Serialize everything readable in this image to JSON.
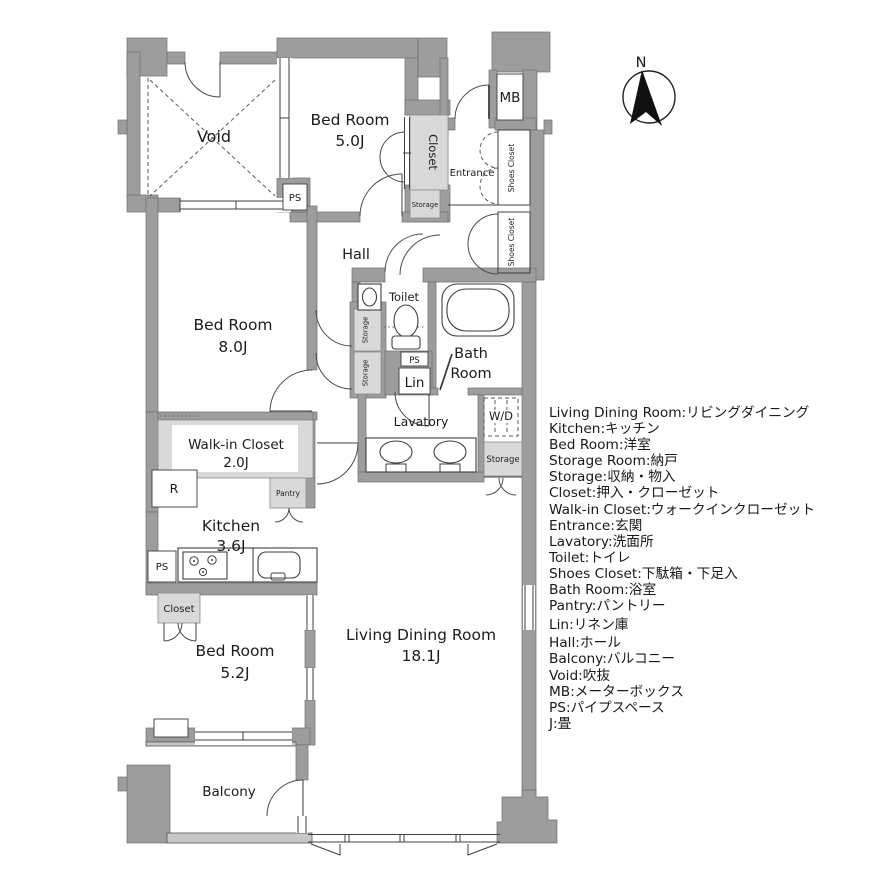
{
  "plan": {
    "rooms": {
      "void": {
        "label": "Void"
      },
      "bedroom5": {
        "name": "Bed Room",
        "size": "5.0J"
      },
      "bedroom8": {
        "name": "Bed Room",
        "size": "8.0J"
      },
      "bedroom52": {
        "name": "Bed Room",
        "size": "5.2J"
      },
      "living": {
        "name": "Living Dining Room",
        "size": "18.1J"
      },
      "kitchen": {
        "name": "Kitchen",
        "size": "3.6J"
      },
      "wic": {
        "name": "Walk-in Closet",
        "size": "2.0J"
      },
      "hall": {
        "label": "Hall"
      },
      "entrance": {
        "label": "Entrance"
      },
      "toilet": {
        "label": "Toilet"
      },
      "bath": {
        "line1": "Bath",
        "line2": "Room"
      },
      "lavatory": {
        "label": "Lavatory"
      },
      "balcony": {
        "label": "Balcony"
      }
    },
    "small_labels": {
      "mb": "MB",
      "ps": "PS",
      "lin": "Lin",
      "wd": "W/D",
      "r": "R",
      "closet": "Closet",
      "storage": "Storage",
      "pantry": "Pantry",
      "shoes_closet": "Shoes Closet"
    },
    "compass": {
      "north": "N"
    }
  },
  "legend": {
    "items": [
      "Living Dining Room:リビングダイニング",
      "Kitchen:キッチン",
      "Bed Room:洋室",
      "Storage Room:納戸",
      "Storage:収納・物入",
      "Closet:押入・クローゼット",
      "Walk-in Closet:ウォークインクローゼット",
      "Entrance:玄関",
      "Lavatory:洗面所",
      "Toilet:トイレ",
      "Shoes Closet:下駄箱・下足入",
      "Bath Room:浴室",
      "Pantry:パントリー",
      "Lin:リネン庫",
      "Hall:ホール",
      "Balcony:バルコニー",
      "Void:吹抜",
      "MB:メーターボックス",
      "PS:パイプスペース",
      "J:畳"
    ]
  },
  "colors": {
    "wall": "#9d9d9d",
    "wall_border": "#6f6f6f",
    "shaded_area": "#d9d9d9",
    "line": "#3f3f3f",
    "text": "#1c1c1c"
  }
}
